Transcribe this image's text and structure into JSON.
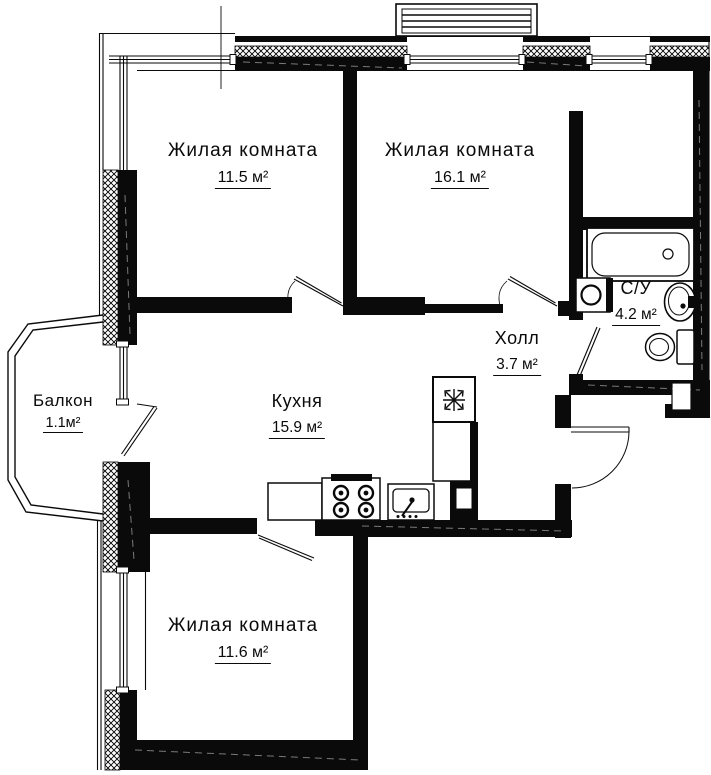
{
  "plan_title": "apartment-floor-plan",
  "rooms": {
    "living1": {
      "label": "Жилая комната",
      "area": "11.5 м²"
    },
    "living2": {
      "label": "Жилая комната",
      "area": "16.1 м²"
    },
    "kitchen": {
      "label": "Кухня",
      "area": "15.9 м²"
    },
    "hall": {
      "label": "Холл",
      "area": "3.7 м²"
    },
    "bathroom": {
      "label": "С/У",
      "area": "4.2 м²"
    },
    "balcony": {
      "label": "Балкон",
      "area": "1.1м²"
    },
    "living3": {
      "label": "Жилая комната",
      "area": "11.6 м²"
    }
  },
  "fixtures": {
    "bathtub": "bathtub",
    "washing_machine": "washing-machine",
    "bathroom_sink": "bathroom-sink",
    "toilet": "toilet",
    "stove": "stove-4-burners",
    "kitchen_sink": "kitchen-sink",
    "fridge": "fridge-snowflake",
    "counter": "kitchen-counter"
  },
  "colors": {
    "wall": "#0a0a0a",
    "background": "#ffffff"
  }
}
